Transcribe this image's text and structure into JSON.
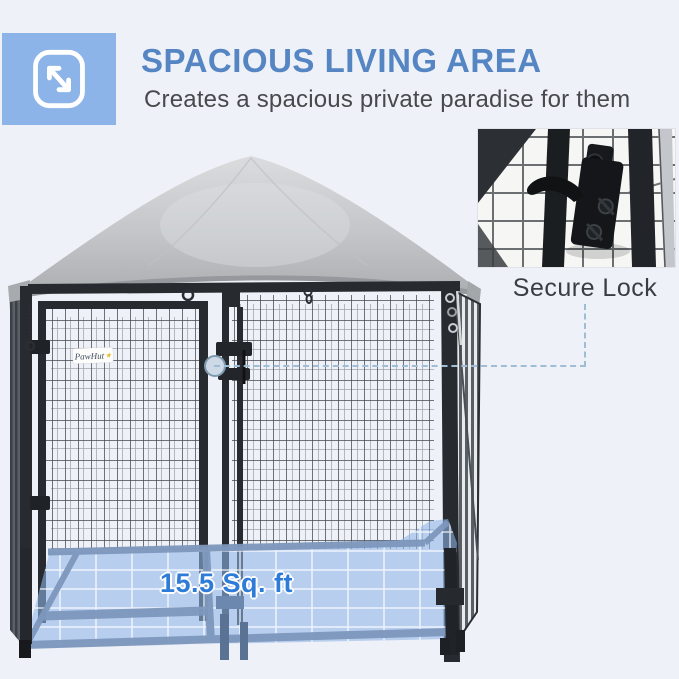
{
  "header": {
    "title": "SPACIOUS LIVING AREA",
    "subtitle": "Creates a spacious private paradise for them",
    "title_color": "#5585c3",
    "subtitle_color": "#47494d",
    "icon": "expand-arrows-icon",
    "icon_bg_color": "#8db4e8"
  },
  "callout": {
    "label": "Secure Lock",
    "label_color": "#3a3e44",
    "dashed_line_color": "#9fbed6"
  },
  "product": {
    "brand": "PawHut",
    "paw_icon": "★",
    "floor_area_label": "15.5 Sq. ft",
    "floor_label_color": "#2e7cd8",
    "canopy_color": "#c3c5c8",
    "frame_color": "#272b30",
    "floor_overlay_color": "#8fb5e8"
  },
  "background_color": "#eef1f7"
}
